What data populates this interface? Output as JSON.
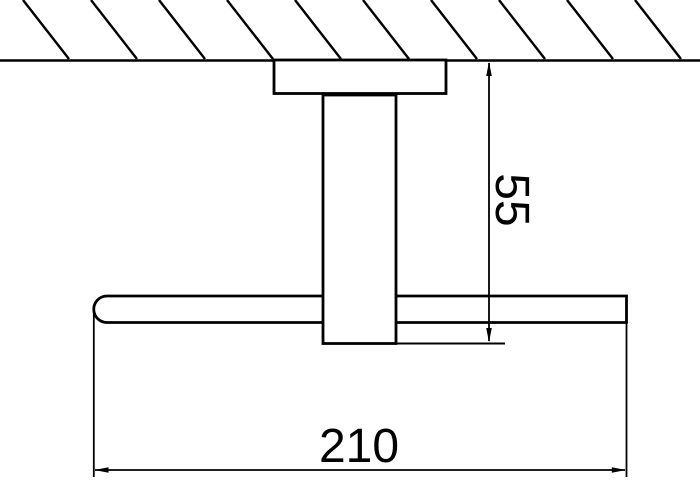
{
  "dimensions": {
    "stem_length": {
      "label": "55"
    },
    "bar_width": {
      "label": "210"
    }
  },
  "colors": {
    "line": "#000000",
    "background": "#ffffff"
  }
}
